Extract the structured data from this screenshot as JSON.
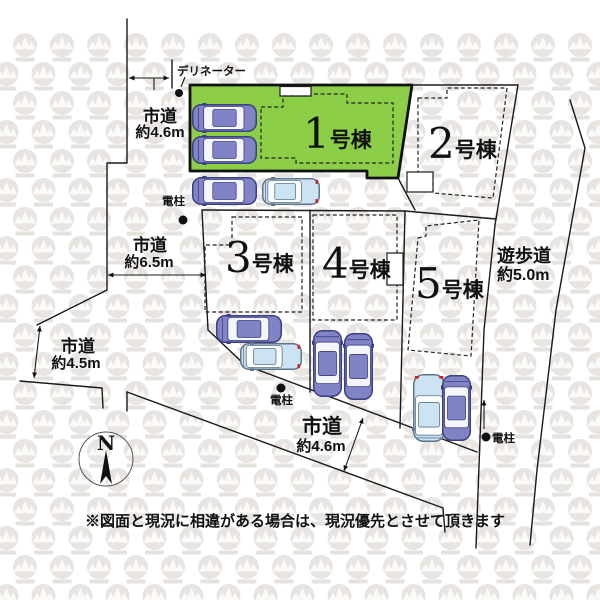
{
  "plan": {
    "lots": [
      {
        "num": "1",
        "suffix": "号棟",
        "highlighted": true
      },
      {
        "num": "2",
        "suffix": "号棟",
        "highlighted": false
      },
      {
        "num": "3",
        "suffix": "号棟",
        "highlighted": false
      },
      {
        "num": "4",
        "suffix": "号棟",
        "highlighted": false
      },
      {
        "num": "5",
        "suffix": "号棟",
        "highlighted": false
      }
    ],
    "roads": [
      {
        "name": "市道",
        "width": "約4.6m",
        "position": "top-left"
      },
      {
        "name": "市道",
        "width": "約6.5m",
        "position": "left"
      },
      {
        "name": "市道",
        "width": "約4.5m",
        "position": "bottom-left"
      },
      {
        "name": "市道",
        "width": "約4.6m",
        "position": "bottom"
      },
      {
        "name": "遊歩道",
        "width": "約5.0m",
        "position": "right"
      }
    ],
    "markers": {
      "delineator_label": "デリネーター",
      "pole_label": "電柱"
    },
    "compass_north": "N",
    "disclaimer": "※図面と現況に相違がある場合は、現況優先とさせて頂きます",
    "colors": {
      "highlight_green": "#8CCE47",
      "car_purple": "#8083C6",
      "car_purple_dark": "#3C4080",
      "car_blue": "#CBE3F3",
      "car_blue_dark": "#5E7488",
      "taillight_red": "#C22222",
      "pattern_gray": "#E7E4E1"
    },
    "cars": [
      {
        "type": "sedan",
        "orient": "h",
        "x": 192,
        "y": 104,
        "w": 65,
        "h": 28
      },
      {
        "type": "sedan",
        "orient": "h",
        "x": 192,
        "y": 136,
        "w": 65,
        "h": 28
      },
      {
        "type": "sedan",
        "orient": "h",
        "x": 192,
        "y": 177,
        "w": 65,
        "h": 28
      },
      {
        "type": "van",
        "orient": "h",
        "x": 262,
        "y": 178,
        "w": 58,
        "h": 27
      },
      {
        "type": "sedan",
        "orient": "h",
        "x": 216,
        "y": 315,
        "w": 66,
        "h": 28
      },
      {
        "type": "van",
        "orient": "h",
        "x": 240,
        "y": 343,
        "w": 62,
        "h": 27
      },
      {
        "type": "sedan",
        "orient": "v-up",
        "x": 313,
        "y": 330,
        "w": 29,
        "h": 67
      },
      {
        "type": "sedan",
        "orient": "v-up",
        "x": 344,
        "y": 333,
        "w": 29,
        "h": 67
      },
      {
        "type": "van",
        "orient": "v-down",
        "x": 413,
        "y": 374,
        "w": 32,
        "h": 68
      },
      {
        "type": "sedan",
        "orient": "v-up",
        "x": 442,
        "y": 375,
        "w": 29,
        "h": 66
      }
    ]
  }
}
